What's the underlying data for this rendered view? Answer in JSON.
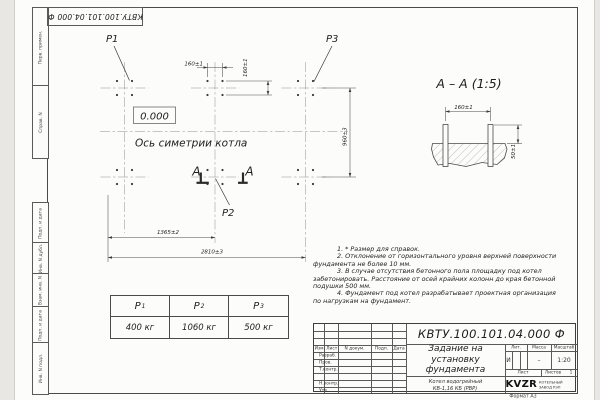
{
  "page": {
    "format_label": "Формат А3"
  },
  "top_stamp": {
    "designation": "КВТУ.100.101.04.000 Ф"
  },
  "margin_labels": [
    "Перв. примен.",
    "Справ. N",
    "Подп. и дата",
    "Инв. N дубл.",
    "Взам. инв. N",
    "Подп. и дата",
    "Инв. N подл."
  ],
  "plan": {
    "load_p1": "P1",
    "load_p2": "P2",
    "load_p3": "P3",
    "elevation": "0.000",
    "axis_label": "Ось симетрии котла",
    "dim_bolt_pitch_h": "160±1",
    "dim_bolt_pitch_v": "160±1",
    "dim_width": "960±3",
    "dim_left_to_mid": "1365±2",
    "dim_overall": "2810±3",
    "section_mark_left": "А",
    "section_mark_right": "А"
  },
  "section_view": {
    "title": "А – А (1:5)",
    "dim_bolt_pitch": "160±1",
    "dim_bolt_height": "50±1"
  },
  "notes": [
    "1. * Размер для справок.",
    "2. Отклонение от горизонтального уровня верхней поверхности",
    "фундамента не более 10 мм.",
    "3. В случае отсутствия бетонного пола площадку под котел",
    "забетонировать. Расстояние от осей крайних колонн до края бетонной",
    "подушки 500 мм.",
    "4. Фундамент под котел разрабатывает проектная организация",
    "по нагрузкам на фундамент."
  ],
  "load_table": {
    "columns": [
      {
        "symbol": "P",
        "sub": "1",
        "value": "400 кг"
      },
      {
        "symbol": "P",
        "sub": "2",
        "value": "1060 кг"
      },
      {
        "symbol": "P",
        "sub": "3",
        "value": "500 кг"
      }
    ]
  },
  "title_block": {
    "designation": "КВТУ.100.101.04.000 Ф",
    "doc_title": [
      "Задание на",
      "установку",
      "фундамента"
    ],
    "product": [
      "Котел водогрейный",
      "КВ-1,16 КБ (РВР)"
    ],
    "col_izm": "Изм. Лист",
    "col_doc": "N докум.",
    "col_podp": "Подп.",
    "col_data": "Дата",
    "row_razrab": "Разраб.",
    "row_prov": "Пров.",
    "row_tkontr": "Т.контр.",
    "row_nkontr": "Н.контр.",
    "row_utv": "Утв.",
    "lit_label": "Лит.",
    "mass_label": "Масса",
    "scale_label": "Масштаб",
    "lit_value": "И",
    "mass_value": "–",
    "scale_value": "1:20",
    "sheet_label": "Лист",
    "sheets_label": "Листов",
    "sheets_value": "1",
    "logo_text": "KVZR",
    "logo_sub1": "КОТЕЛЬНЫЙ",
    "logo_sub2": "ЗАВОД РЭП"
  }
}
